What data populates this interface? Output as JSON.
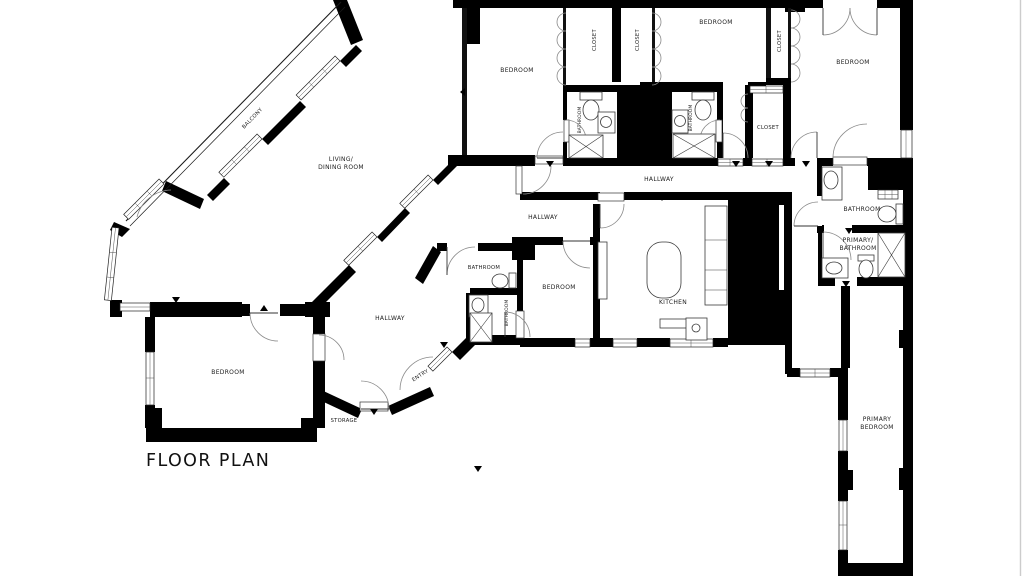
{
  "title": {
    "text": "FLOOR PLAN"
  },
  "colors": {
    "wall": "#000000",
    "background": "#ffffff",
    "door_arc": "#8a8a8a",
    "sheet_edge": "#cccccc"
  },
  "rooms": {
    "balcony": "BALCONY",
    "living_dining_line1": "LIVING/",
    "living_dining_line2": "DINING ROOM",
    "bedroom_top_left": "BEDROOM",
    "closet_a": "CLOSET",
    "closet_b": "CLOSET",
    "bedroom_top_mid": "BEDROOM",
    "closet_c": "CLOSET",
    "bedroom_top_right": "BEDROOM",
    "bathroom_a": "BATHROOM",
    "bathroom_b": "BATHROOM",
    "closet_d": "CLOSET",
    "hallway_main": "HALLWAY",
    "bathroom_right": "BATHROOM",
    "primary_bathroom_line1": "PRIMARY/",
    "primary_bathroom_line2": "BATHROOM",
    "hallway_left": "HALLWAY",
    "bathroom_mid": "BATHROOM",
    "bathroom_small": "BATHROOM",
    "bedroom_mid": "BEDROOM",
    "kitchen": "KITCHEN",
    "hallway_diag": "HALLWAY",
    "entry": "ENTRY",
    "storage": "STORAGE",
    "bedroom_bottom_left": "BEDROOM",
    "primary_bedroom_line1": "PRIMARY",
    "primary_bedroom_line2": "BEDROOM"
  }
}
